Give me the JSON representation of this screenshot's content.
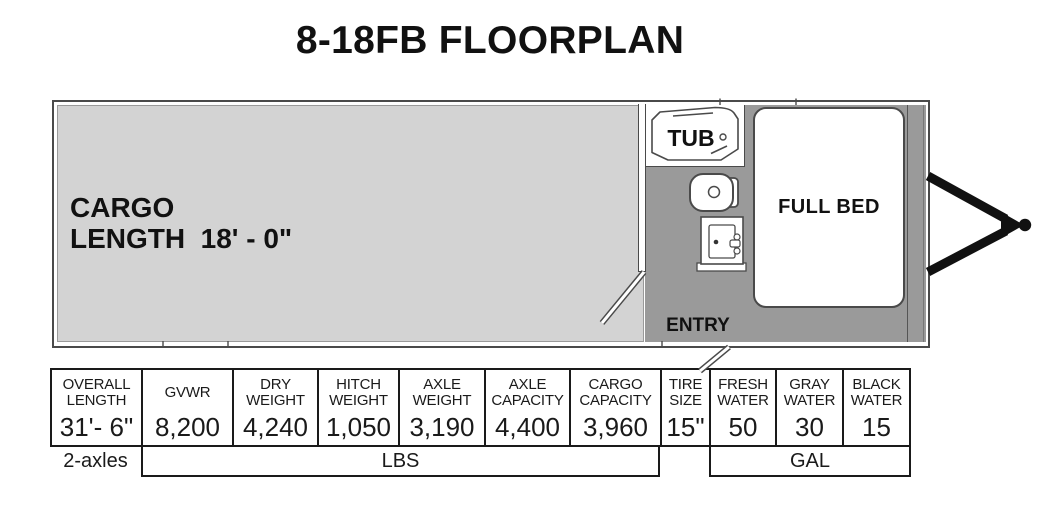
{
  "title": "8-18FB FLOORPLAN",
  "floorplan": {
    "cargo_line1": "CARGO",
    "cargo_line2": "LENGTH  18' - 0\"",
    "tub": "TUB",
    "bed": "FULL BED",
    "entry": "ENTRY",
    "colors": {
      "cargo_floor": "#d3d3d3",
      "living_floor": "#9a9a9a",
      "wall_outline": "#4a4a4a",
      "hitch": "#111111",
      "table_border": "#1a1a1a"
    }
  },
  "spec_table": {
    "columns": [
      {
        "header": "OVERALL LENGTH",
        "value": "31'- 6\""
      },
      {
        "header": "GVWR",
        "value": "8,200"
      },
      {
        "header": "DRY WEIGHT",
        "value": "4,240"
      },
      {
        "header": "HITCH WEIGHT",
        "value": "1,050"
      },
      {
        "header": "AXLE WEIGHT",
        "value": "3,190"
      },
      {
        "header": "AXLE CAPACITY",
        "value": "4,400"
      },
      {
        "header": "CARGO CAPACITY",
        "value": "3,960"
      },
      {
        "header": "TIRE SIZE",
        "value": "15\""
      },
      {
        "header": "FRESH WATER",
        "value": "50"
      },
      {
        "header": "GRAY WATER",
        "value": "30"
      },
      {
        "header": "BLACK WATER",
        "value": "15"
      }
    ],
    "axles": "2-axles",
    "weights_unit": "LBS",
    "volumes_unit": "GAL"
  }
}
